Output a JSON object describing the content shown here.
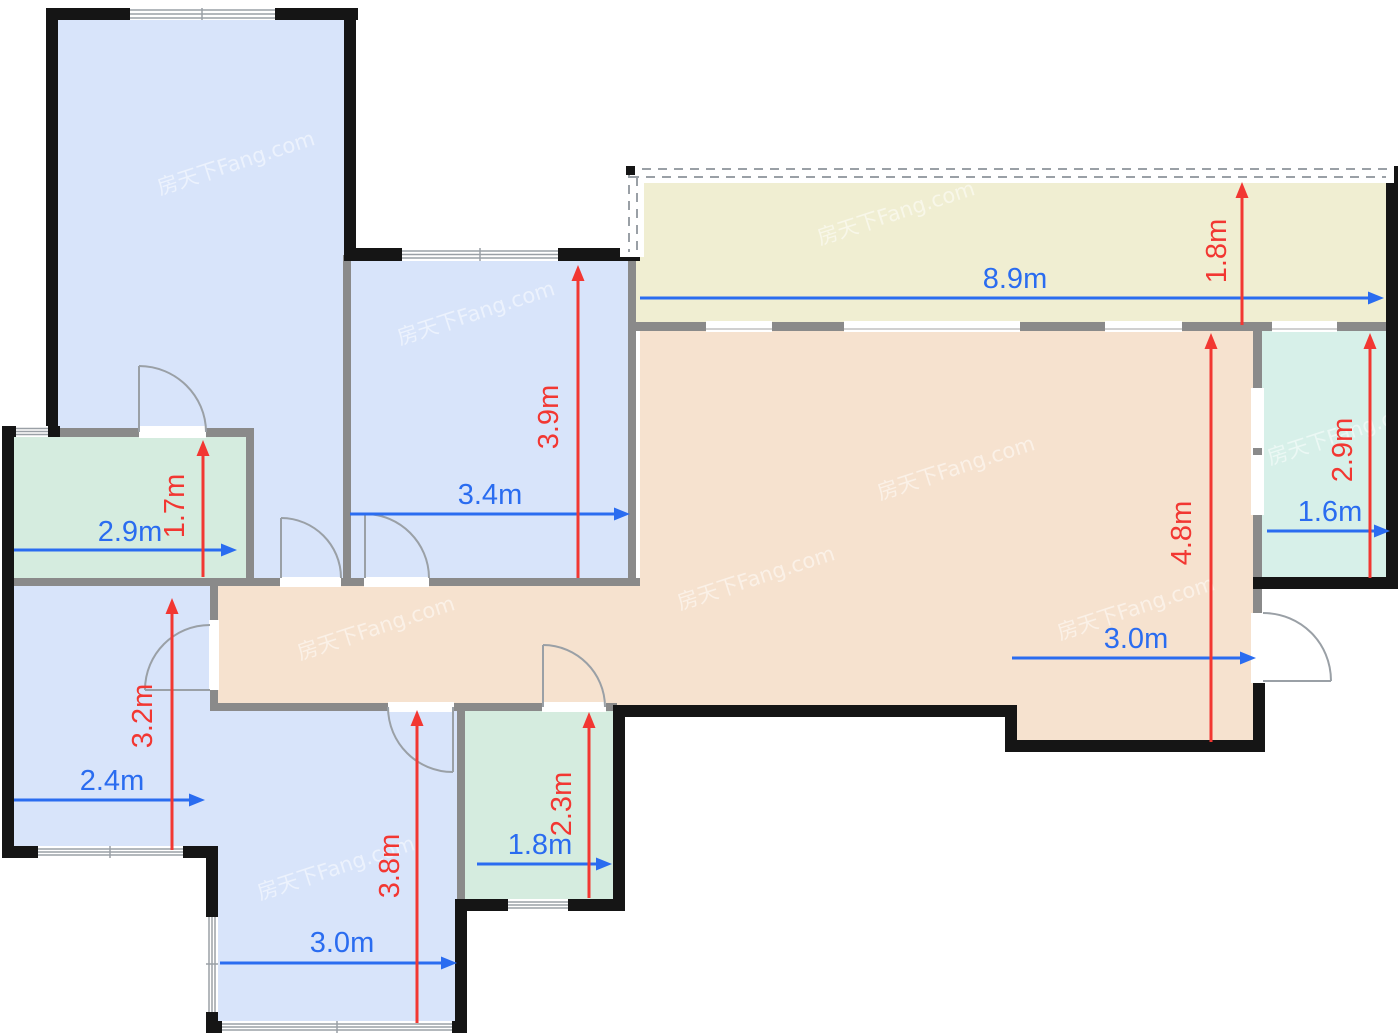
{
  "watermark": {
    "text": "房天下Fang.com"
  },
  "colors": {
    "wall_black": "#151515",
    "wall_gray": "#8a8a8a",
    "bedroom_fill": "#d8e4fa",
    "bathroom_fill": "#d5ecdf",
    "bathroom_right_fill": "#d7f0e9",
    "living_fill": "#f6e2cf",
    "balcony_fill": "#f0eed2",
    "dim_red": "#f23732",
    "dim_blue": "#2a6cf0"
  },
  "dimensions": {
    "balcony": {
      "width": "8.9m",
      "depth": "1.8m"
    },
    "bedroom_mid_top": {
      "width": "3.4m",
      "depth": "3.9m"
    },
    "bath_left": {
      "width": "2.9m",
      "depth": "1.7m"
    },
    "bedroom_left": {
      "width": "2.4m",
      "depth": "3.2m"
    },
    "bedroom_bottom": {
      "width": "3.0m",
      "depth": "3.8m"
    },
    "bath_mid": {
      "width": "1.8m",
      "depth": "2.3m"
    },
    "living": {
      "width": "3.0m",
      "depth": "4.8m"
    },
    "bath_right": {
      "width": "1.6m",
      "depth": "2.9m"
    }
  }
}
